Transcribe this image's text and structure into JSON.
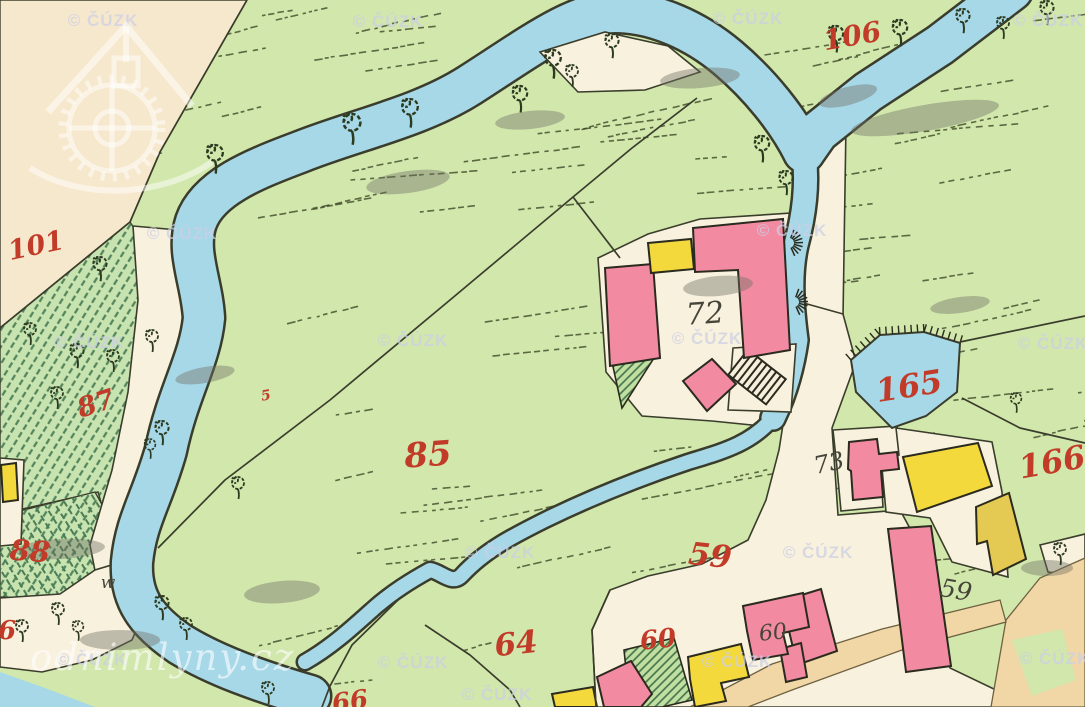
{
  "map": {
    "description": "Historical hand-drawn cadastral map scan with stream, mill buildings and parcel numbers",
    "parcel_labels_red": [
      {
        "text": "101",
        "x": 36,
        "y": 246,
        "size": 27,
        "rot": -12
      },
      {
        "text": "106",
        "x": 852,
        "y": 36,
        "size": 28,
        "rot": -10
      },
      {
        "text": "87",
        "x": 96,
        "y": 404,
        "size": 27,
        "rot": -18
      },
      {
        "text": "88",
        "x": 30,
        "y": 551,
        "size": 29,
        "rot": 4
      },
      {
        "text": "85",
        "x": 428,
        "y": 455,
        "size": 34,
        "rot": -4
      },
      {
        "text": "5",
        "x": 266,
        "y": 396,
        "size": 14,
        "rot": -10
      },
      {
        "text": "59",
        "x": 710,
        "y": 556,
        "size": 31,
        "rot": 6
      },
      {
        "text": "64",
        "x": 516,
        "y": 644,
        "size": 31,
        "rot": -6
      },
      {
        "text": "60",
        "x": 658,
        "y": 640,
        "size": 26,
        "rot": -6
      },
      {
        "text": "66",
        "x": 350,
        "y": 702,
        "size": 26,
        "rot": -8
      },
      {
        "text": "6",
        "x": 7,
        "y": 631,
        "size": 26,
        "rot": 0
      },
      {
        "text": "165",
        "x": 909,
        "y": 386,
        "size": 32,
        "rot": -9
      },
      {
        "text": "166",
        "x": 1052,
        "y": 462,
        "size": 32,
        "rot": -10
      }
    ],
    "house_labels_black": [
      {
        "text": "72",
        "x": 705,
        "y": 314,
        "size": 30,
        "rot": -4
      },
      {
        "text": "73",
        "x": 829,
        "y": 463,
        "size": 24,
        "rot": -12
      },
      {
        "text": "59",
        "x": 956,
        "y": 590,
        "size": 25,
        "rot": 10
      },
      {
        "text": "60",
        "x": 773,
        "y": 633,
        "size": 22,
        "rot": -6
      },
      {
        "text": "w",
        "x": 108,
        "y": 583,
        "size": 17,
        "rot": 0
      }
    ],
    "watermark": {
      "text": "© ČÚZK",
      "css_color": "rgba(204,206,228,0.72)",
      "positions": [
        [
          103,
          21
        ],
        [
          388,
          22
        ],
        [
          748,
          19
        ],
        [
          1048,
          21
        ],
        [
          182,
          234
        ],
        [
          89,
          343
        ],
        [
          413,
          341
        ],
        [
          792,
          231
        ],
        [
          707,
          339
        ],
        [
          1053,
          344
        ],
        [
          500,
          553
        ],
        [
          818,
          553
        ],
        [
          92,
          660
        ],
        [
          413,
          663
        ],
        [
          737,
          662
        ],
        [
          1055,
          659
        ],
        [
          497,
          695
        ]
      ]
    },
    "site_watermark": {
      "text": "odnimlyny.cz"
    },
    "palette": {
      "meadow": "#d1e7ac",
      "paper": "#f6e8cd",
      "road": "#f8f1de",
      "water": "#a7d8e8",
      "masonry": "#f28aa2",
      "wood": "#f3d93c",
      "wood_dark": "#e4ca52",
      "tan": "#f1d6a6",
      "line_dark": "#3a3d2b",
      "label_red": "#c23a28",
      "label_black": "#46453a"
    }
  }
}
